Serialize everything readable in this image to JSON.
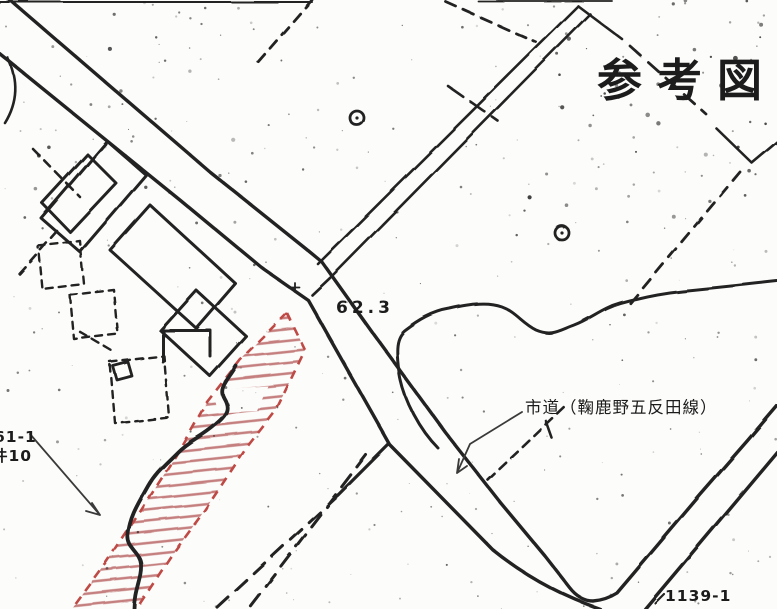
{
  "map": {
    "title": "参考図",
    "spot_elevation": "62.3",
    "road_label": "市道（鞠鹿野五反田線）",
    "left_parcel_label": {
      "line1": "61-1",
      "line2": "件10"
    },
    "bottom_parcel_number": "1139-1",
    "colors": {
      "ink": "#242424",
      "paper": "#fcfcfa",
      "hatch_red": "#c47f7e",
      "border_red": "#bf4a45"
    }
  }
}
